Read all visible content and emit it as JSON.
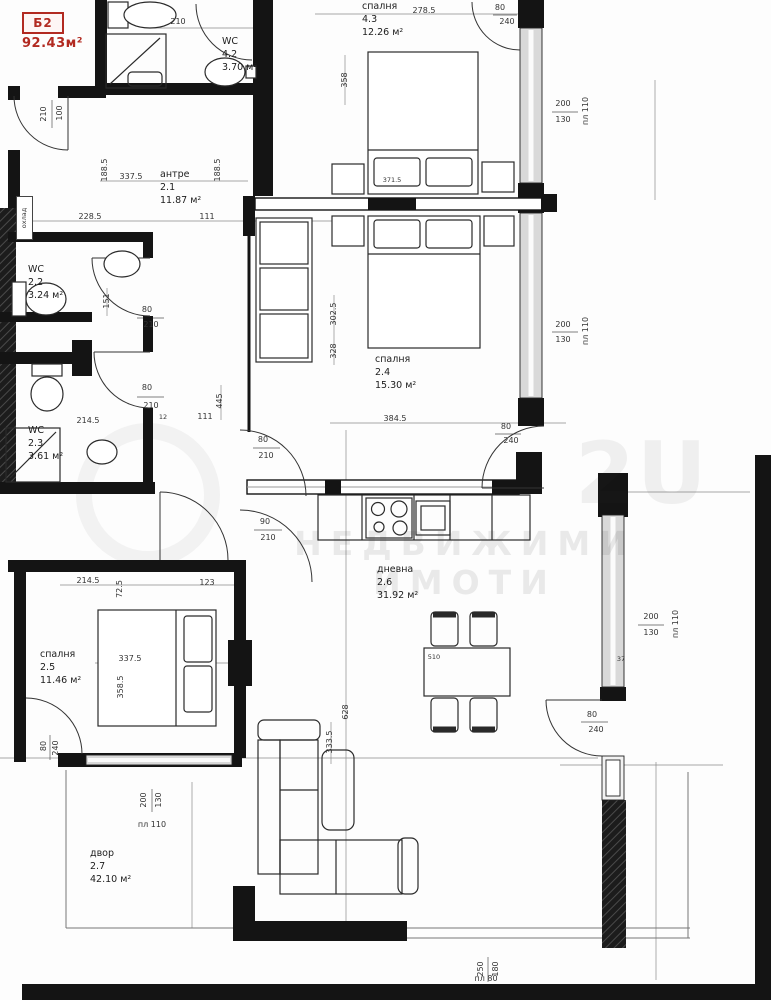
{
  "unit_tag": {
    "code": "Б2",
    "area": "92.43м²"
  },
  "watermark": {
    "logo": "2U",
    "text": "НЕДВИЖИМИ ИМОТИ"
  },
  "annotations": {
    "cooler": "охлад"
  },
  "rooms": {
    "wc42": {
      "name": "WC",
      "number": "4.2",
      "area": "3.70 м²"
    },
    "bedroom43": {
      "name": "спалня",
      "number": "4.3",
      "area": "12.26 м²"
    },
    "antre21": {
      "name": "антре",
      "number": "2.1",
      "area": "11.87 м²"
    },
    "wc22": {
      "name": "WC",
      "number": "2.2",
      "area": "3.24 м²"
    },
    "wc23": {
      "name": "WC",
      "number": "2.3",
      "area": "3.61 м²"
    },
    "bedroom24": {
      "name": "спалня",
      "number": "2.4",
      "area": "15.30 м²"
    },
    "living26": {
      "name": "дневна",
      "number": "2.6",
      "area": "31.92 м²"
    },
    "bedroom25": {
      "name": "спалня",
      "number": "2.5",
      "area": "11.46 м²"
    },
    "yard27": {
      "name": "двор",
      "number": "2.7",
      "area": "42.10 м²"
    }
  },
  "dims": [
    {
      "t": "210"
    },
    {
      "t": "278.5"
    },
    {
      "t": "80"
    },
    {
      "t": "240"
    },
    {
      "t": "200"
    },
    {
      "t": "130"
    },
    {
      "t": "пл 110"
    },
    {
      "t": "358"
    },
    {
      "t": "371.5"
    },
    {
      "t": "188.5"
    },
    {
      "t": "337.5"
    },
    {
      "t": "188.5"
    },
    {
      "t": "111"
    },
    {
      "t": "228.5"
    },
    {
      "t": "210"
    },
    {
      "t": "100"
    },
    {
      "t": "151"
    },
    {
      "t": "80"
    },
    {
      "t": "210"
    },
    {
      "t": "80"
    },
    {
      "t": "210"
    },
    {
      "t": "445"
    },
    {
      "t": "12"
    },
    {
      "t": "111"
    },
    {
      "t": "214.5"
    },
    {
      "t": "302.5"
    },
    {
      "t": "328"
    },
    {
      "t": "200"
    },
    {
      "t": "130"
    },
    {
      "t": "пл 110"
    },
    {
      "t": "384.5"
    },
    {
      "t": "80"
    },
    {
      "t": "240"
    },
    {
      "t": "80"
    },
    {
      "t": "210"
    },
    {
      "t": "90"
    },
    {
      "t": "210"
    },
    {
      "t": "214.5"
    },
    {
      "t": "123"
    },
    {
      "t": "72.5"
    },
    {
      "t": "337.5"
    },
    {
      "t": "358.5"
    },
    {
      "t": "510"
    },
    {
      "t": "628"
    },
    {
      "t": "333.5"
    },
    {
      "t": "200"
    },
    {
      "t": "130"
    },
    {
      "t": "пл 110"
    },
    {
      "t": "37"
    },
    {
      "t": "80"
    },
    {
      "t": "240"
    },
    {
      "t": "80"
    },
    {
      "t": "240"
    },
    {
      "t": "200"
    },
    {
      "t": "130"
    },
    {
      "t": "пл 110"
    },
    {
      "t": "250"
    },
    {
      "t": "180"
    },
    {
      "t": "пл 80"
    }
  ]
}
